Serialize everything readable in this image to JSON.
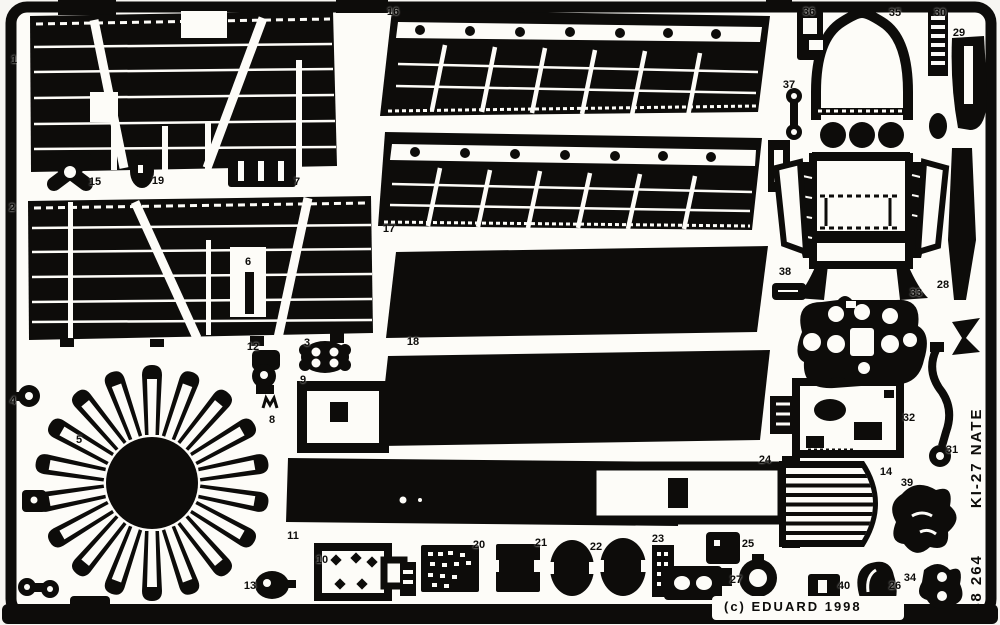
{
  "sheet": {
    "brand_line": "(c) EDUARD 1998",
    "side_code": "48 264",
    "side_title": "KI-27 NATE",
    "colors": {
      "ink": "#0d0c0a",
      "paper": "#fdfcf8"
    }
  },
  "parts": [
    {
      "num": "1",
      "x": 14,
      "y": 60
    },
    {
      "num": "2",
      "x": 12,
      "y": 208
    },
    {
      "num": "3",
      "x": 307,
      "y": 343
    },
    {
      "num": "4",
      "x": 13,
      "y": 401
    },
    {
      "num": "5",
      "x": 79,
      "y": 440
    },
    {
      "num": "6",
      "x": 248,
      "y": 262
    },
    {
      "num": "7",
      "x": 297,
      "y": 182
    },
    {
      "num": "8",
      "x": 272,
      "y": 420
    },
    {
      "num": "9",
      "x": 303,
      "y": 380
    },
    {
      "num": "10",
      "x": 322,
      "y": 560
    },
    {
      "num": "11",
      "x": 293,
      "y": 536
    },
    {
      "num": "12",
      "x": 253,
      "y": 347
    },
    {
      "num": "13",
      "x": 250,
      "y": 586
    },
    {
      "num": "14",
      "x": 886,
      "y": 472
    },
    {
      "num": "15",
      "x": 95,
      "y": 182
    },
    {
      "num": "16",
      "x": 393,
      "y": 12
    },
    {
      "num": "17",
      "x": 389,
      "y": 229
    },
    {
      "num": "18",
      "x": 413,
      "y": 342
    },
    {
      "num": "19",
      "x": 158,
      "y": 181
    },
    {
      "num": "20",
      "x": 479,
      "y": 545
    },
    {
      "num": "21",
      "x": 541,
      "y": 543
    },
    {
      "num": "22",
      "x": 596,
      "y": 547
    },
    {
      "num": "23",
      "x": 658,
      "y": 539
    },
    {
      "num": "24",
      "x": 765,
      "y": 460
    },
    {
      "num": "25",
      "x": 748,
      "y": 544
    },
    {
      "num": "26",
      "x": 895,
      "y": 586
    },
    {
      "num": "27",
      "x": 736,
      "y": 580
    },
    {
      "num": "28",
      "x": 943,
      "y": 285
    },
    {
      "num": "29",
      "x": 959,
      "y": 33
    },
    {
      "num": "30",
      "x": 940,
      "y": 13
    },
    {
      "num": "31",
      "x": 952,
      "y": 450
    },
    {
      "num": "32",
      "x": 909,
      "y": 418
    },
    {
      "num": "33",
      "x": 916,
      "y": 293
    },
    {
      "num": "34",
      "x": 910,
      "y": 578
    },
    {
      "num": "35",
      "x": 895,
      "y": 13
    },
    {
      "num": "36",
      "x": 809,
      "y": 12
    },
    {
      "num": "37",
      "x": 789,
      "y": 85
    },
    {
      "num": "38",
      "x": 785,
      "y": 272
    },
    {
      "num": "39",
      "x": 907,
      "y": 483
    },
    {
      "num": "40",
      "x": 844,
      "y": 586
    }
  ]
}
